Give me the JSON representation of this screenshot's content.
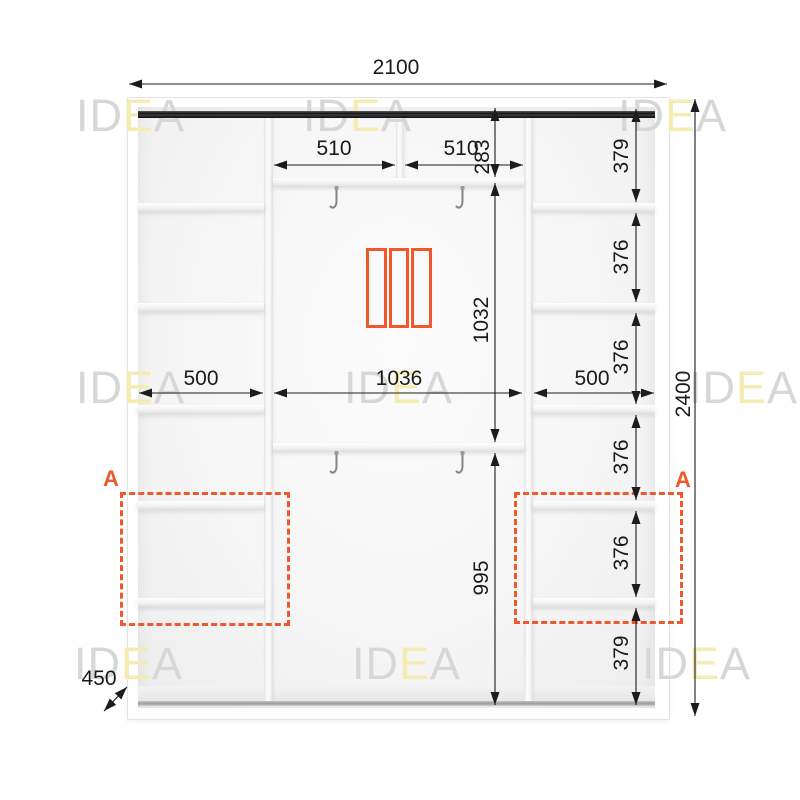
{
  "watermark": {
    "left": "ID",
    "accent": "E",
    "right": "A"
  },
  "dims": {
    "width_total": "2100",
    "height_total": "2400",
    "depth": "450",
    "top_left_compartment": "510",
    "top_right_compartment": "510",
    "top_section_height": "283",
    "middle_section_height": "1032",
    "bottom_section_height": "995",
    "left_shelf_width": "500",
    "center_width": "1036",
    "right_shelf_width": "500",
    "right_column_heights": [
      "379",
      "376",
      "376",
      "376",
      "376",
      "379"
    ]
  },
  "labels": {
    "section_a_left": "A",
    "section_a_right": "A"
  },
  "colors": {
    "accent": "#ED582D",
    "dimension_text": "#1A1A1A",
    "watermark_gray": "#D7D7D7",
    "watermark_yellow": "#F5ECB4"
  }
}
